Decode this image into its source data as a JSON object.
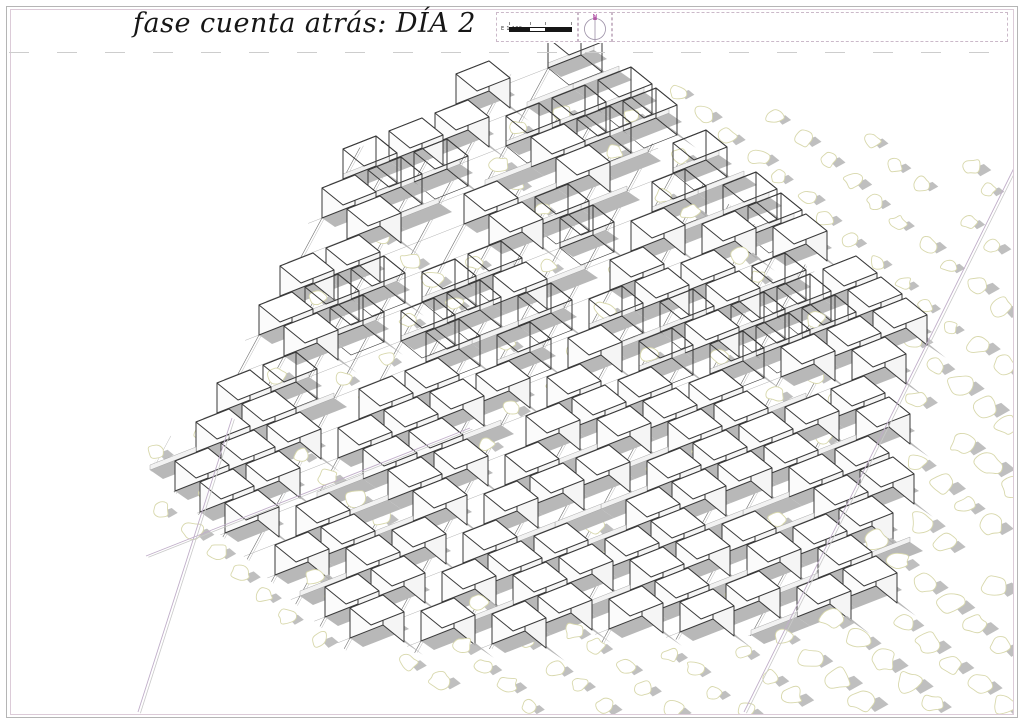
{
  "page": {
    "title": "fase cuenta atrás: DÍA 2"
  },
  "scalebar": {
    "label": "E 1:100"
  },
  "north": {
    "label": "N"
  },
  "colors": {
    "paper": "#ffffff",
    "ink": "#3a3a3a",
    "shadow": "#b8b8b8",
    "wall_fill": "#f2f2f2",
    "wall_edge": "#979797",
    "tree_line": "#d8d8ac",
    "tree_fill": "#ffffff",
    "rail_dark": "#6f6f6f",
    "rail_light": "#b9b9b9",
    "row_line": "#a8a8a8",
    "boundary_pink": "#c0aec9",
    "boundary_gray": "#c9c9c9",
    "border_outer": "#b5b5b5",
    "border_inner": "#dccbd8",
    "dashed_box": "#cbb9c9",
    "north_magenta": "#b457a8",
    "title_ink": "#161616"
  },
  "drawing": {
    "seed": 20240712,
    "origin": [
      150,
      470
    ],
    "axis_u": [
      46,
      -18
    ],
    "axis_b": [
      25,
      21
    ],
    "i_range": [
      -5,
      20
    ],
    "j_range": [
      -13,
      20
    ],
    "cube": {
      "u": [
        33,
        -13
      ],
      "b": [
        21,
        17
      ],
      "h": 30,
      "prob": 0.8,
      "frame_prob": 0.5,
      "frame_below_y": 400
    },
    "wall": {
      "h": 5,
      "shadow": [
        13,
        9
      ]
    },
    "cube_shadow": [
      19,
      13
    ],
    "tree": {
      "r_min": 7,
      "r_max": 11,
      "orchard_prob": 0.93,
      "block_prob": 0.55,
      "street_prob": 0.85,
      "near_cube_prob": 0.25,
      "jitter": 10
    },
    "built_polygon": [
      [
        544,
        58
      ],
      [
        878,
        322
      ],
      [
        866,
        630
      ],
      [
        352,
        656
      ],
      [
        150,
        470
      ],
      [
        330,
        162
      ]
    ],
    "orchard_polygon": [
      [
        540,
        50
      ],
      [
        1014,
        166
      ],
      [
        1014,
        712
      ],
      [
        420,
        712
      ],
      [
        136,
        520
      ],
      [
        146,
        460
      ]
    ],
    "streets_steep": [
      4,
      9
    ],
    "streets_shallow": [
      5,
      11
    ],
    "boundaries": [
      {
        "pts": [
          [
            1014,
            168
          ],
          [
            744,
            712
          ]
        ]
      },
      {
        "pts": [
          [
            232,
            418
          ],
          [
            138,
            712
          ]
        ]
      },
      {
        "pts": [
          [
            146,
            556
          ],
          [
            470,
            428
          ]
        ]
      }
    ],
    "orchard_strip_line": {
      "a": [
        1014,
        168
      ],
      "b": [
        744,
        712
      ]
    }
  }
}
